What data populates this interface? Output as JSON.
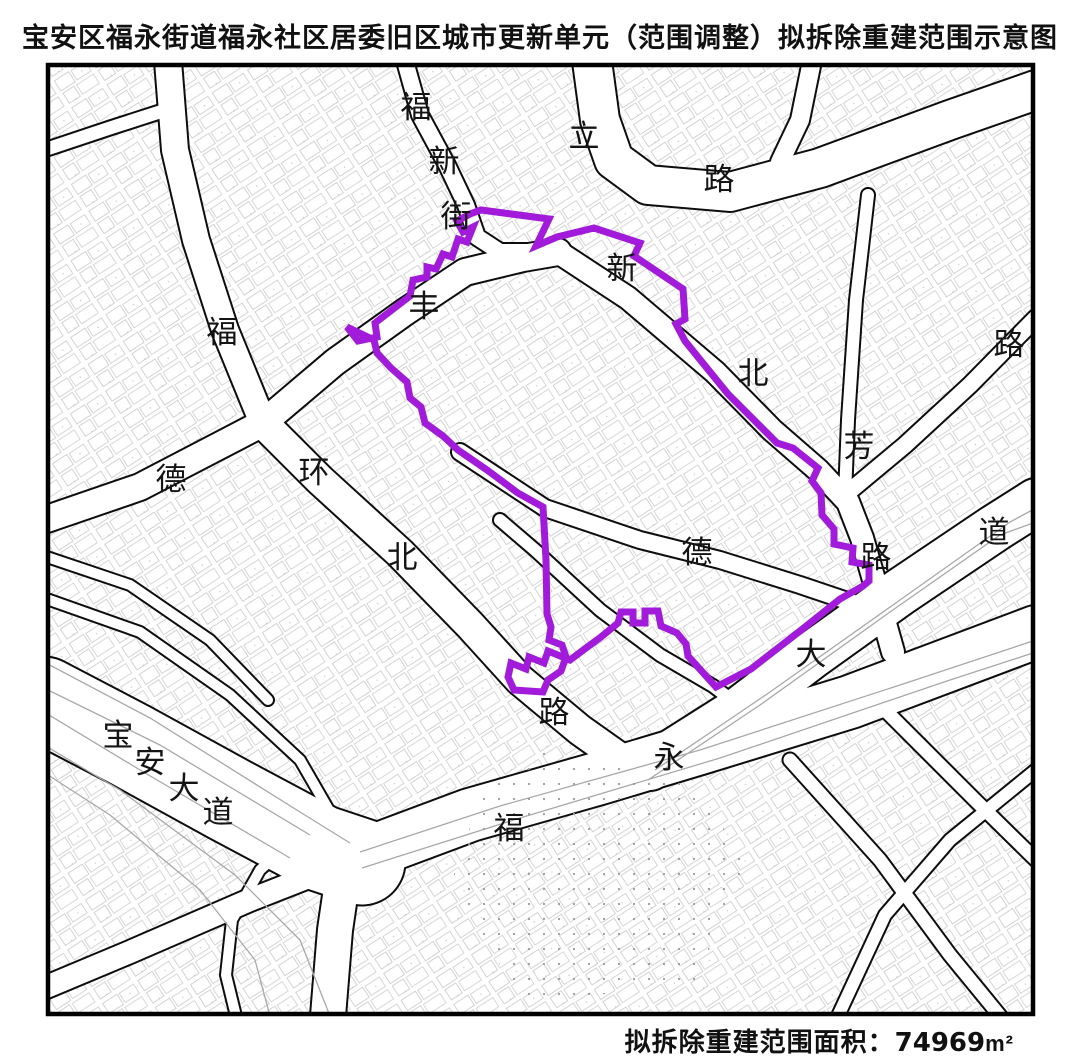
{
  "title": "宝安区福永街道福永社区居委旧区城市更新单元（范围调整）拟拆除重建范围示意图",
  "caption": {
    "label": "拟拆除重建范围面积：",
    "value": "74969",
    "unit": "m²"
  },
  "colors": {
    "boundary": "#A21BDA",
    "road_edge": "#0d0d0d",
    "road_fill": "#ffffff",
    "lane_line": "#a8a8a8",
    "parcel_line": "#c6c6c6",
    "frame": "#000000",
    "label_text": "#141414"
  },
  "map": {
    "frame": {
      "x": 48,
      "y": 65,
      "width": 985,
      "height": 949
    },
    "boundary_polygon": {
      "name": "proposed-demolition-rebuild-boundary",
      "stroke_width": 7,
      "points": [
        [
          347,
          327
        ],
        [
          358,
          341
        ],
        [
          377,
          337
        ],
        [
          375,
          323
        ],
        [
          410,
          296
        ],
        [
          413,
          280
        ],
        [
          427,
          277
        ],
        [
          427,
          267
        ],
        [
          436,
          269
        ],
        [
          443,
          254
        ],
        [
          452,
          257
        ],
        [
          458,
          239
        ],
        [
          467,
          242
        ],
        [
          473,
          227
        ],
        [
          463,
          232
        ],
        [
          457,
          221
        ],
        [
          470,
          214
        ],
        [
          481,
          210
        ],
        [
          549,
          219
        ],
        [
          536,
          246
        ],
        [
          557,
          237
        ],
        [
          594,
          228
        ],
        [
          640,
          243
        ],
        [
          634,
          256
        ],
        [
          683,
          289
        ],
        [
          685,
          319
        ],
        [
          676,
          324
        ],
        [
          685,
          341
        ],
        [
          702,
          362
        ],
        [
          728,
          394
        ],
        [
          748,
          414
        ],
        [
          777,
          443
        ],
        [
          793,
          448
        ],
        [
          818,
          468
        ],
        [
          812,
          481
        ],
        [
          821,
          493
        ],
        [
          822,
          515
        ],
        [
          834,
          529
        ],
        [
          834,
          544
        ],
        [
          853,
          548
        ],
        [
          852,
          562
        ],
        [
          869,
          565
        ],
        [
          869,
          581
        ],
        [
          863,
          586
        ],
        [
          840,
          599
        ],
        [
          800,
          631
        ],
        [
          751,
          669
        ],
        [
          716,
          687
        ],
        [
          688,
          656
        ],
        [
          686,
          644
        ],
        [
          677,
          633
        ],
        [
          661,
          626
        ],
        [
          658,
          611
        ],
        [
          645,
          611
        ],
        [
          645,
          623
        ],
        [
          633,
          623
        ],
        [
          633,
          612
        ],
        [
          621,
          612
        ],
        [
          618,
          623
        ],
        [
          601,
          637
        ],
        [
          586,
          648
        ],
        [
          570,
          660
        ],
        [
          548,
          651
        ],
        [
          544,
          663
        ],
        [
          529,
          657
        ],
        [
          526,
          669
        ],
        [
          511,
          663
        ],
        [
          508,
          677
        ],
        [
          514,
          690
        ],
        [
          543,
          692
        ],
        [
          548,
          680
        ],
        [
          561,
          671
        ],
        [
          566,
          657
        ],
        [
          562,
          645
        ],
        [
          549,
          640
        ],
        [
          551,
          627
        ],
        [
          547,
          614
        ],
        [
          546,
          560
        ],
        [
          543,
          507
        ],
        [
          518,
          493
        ],
        [
          487,
          470
        ],
        [
          458,
          450
        ],
        [
          443,
          436
        ],
        [
          425,
          423
        ],
        [
          421,
          407
        ],
        [
          410,
          398
        ],
        [
          407,
          382
        ],
        [
          391,
          368
        ],
        [
          377,
          353
        ],
        [
          374,
          340
        ]
      ]
    },
    "roads": [
      {
        "name": "baoan-avenue",
        "width": 85,
        "points": [
          [
            44,
            700
          ],
          [
            130,
            745
          ],
          [
            230,
            800
          ],
          [
            320,
            848
          ],
          [
            362,
            862
          ]
        ]
      },
      {
        "name": "fuyong-avenue",
        "width": 52,
        "points": [
          [
            355,
            858
          ],
          [
            470,
            815
          ],
          [
            600,
            778
          ],
          [
            700,
            748
          ],
          [
            850,
            702
          ],
          [
            1036,
            632
          ]
        ]
      },
      {
        "name": "dadao-northeast",
        "width": 46,
        "points": [
          [
            650,
            767
          ],
          [
            740,
            710
          ],
          [
            812,
            655
          ],
          [
            900,
            592
          ],
          [
            995,
            528
          ],
          [
            1036,
            502
          ]
        ]
      },
      {
        "name": "south-branch",
        "width": 34,
        "points": [
          [
            345,
            862
          ],
          [
            335,
            930
          ],
          [
            328,
            1016
          ]
        ]
      },
      {
        "name": "southwest-branch",
        "width": 22,
        "points": [
          [
            352,
            860
          ],
          [
            250,
            900
          ],
          [
            130,
            952
          ],
          [
            44,
            988
          ]
        ]
      },
      {
        "name": "interchange-ramp",
        "width": 10,
        "points": [
          [
            310,
            825
          ],
          [
            260,
            870
          ],
          [
            232,
            920
          ],
          [
            226,
            975
          ],
          [
            236,
            1016
          ]
        ]
      },
      {
        "name": "huanbei-road",
        "width": 30,
        "points": [
          [
            263,
            423
          ],
          [
            320,
            480
          ],
          [
            400,
            553
          ],
          [
            470,
            625
          ],
          [
            520,
            680
          ],
          [
            580,
            730
          ],
          [
            628,
            764
          ]
        ]
      },
      {
        "name": "west-branch",
        "width": 26,
        "points": [
          [
            44,
            520
          ],
          [
            140,
            487
          ],
          [
            263,
            423
          ]
        ]
      },
      {
        "name": "north-branch",
        "width": 26,
        "points": [
          [
            263,
            423
          ],
          [
            225,
            330
          ],
          [
            196,
            240
          ],
          [
            175,
            150
          ],
          [
            168,
            61
          ]
        ]
      },
      {
        "name": "fufeng-road",
        "width": 26,
        "points": [
          [
            263,
            423
          ],
          [
            335,
            362
          ],
          [
            405,
            312
          ],
          [
            465,
            272
          ],
          [
            523,
            258
          ],
          [
            558,
            252
          ]
        ]
      },
      {
        "name": "fuxin-street",
        "width": 16,
        "points": [
          [
            405,
            61
          ],
          [
            420,
            115
          ],
          [
            447,
            165
          ],
          [
            466,
            205
          ],
          [
            477,
            237
          ],
          [
            500,
            252
          ],
          [
            545,
            252
          ]
        ]
      },
      {
        "name": "lilu-corridor",
        "width": 38,
        "points": [
          [
            592,
            61
          ],
          [
            600,
            120
          ],
          [
            614,
            160
          ],
          [
            648,
            185
          ],
          [
            730,
            192
          ],
          [
            820,
            168
          ],
          [
            950,
            120
          ],
          [
            1036,
            90
          ]
        ]
      },
      {
        "name": "top-branch",
        "width": 18,
        "points": [
          [
            812,
            61
          ],
          [
            800,
            120
          ],
          [
            780,
            162
          ]
        ]
      },
      {
        "name": "xinbeifang-road",
        "width": 22,
        "points": [
          [
            558,
            252
          ],
          [
            628,
            298
          ],
          [
            715,
            372
          ],
          [
            772,
            430
          ],
          [
            818,
            470
          ],
          [
            848,
            502
          ],
          [
            862,
            538
          ],
          [
            874,
            580
          ],
          [
            884,
            620
          ],
          [
            893,
            652
          ]
        ]
      },
      {
        "name": "de-road",
        "width": 16,
        "points": [
          [
            460,
            452
          ],
          [
            545,
            508
          ],
          [
            640,
            540
          ],
          [
            720,
            560
          ],
          [
            800,
            585
          ],
          [
            880,
            612
          ]
        ]
      },
      {
        "name": "northeast-connector",
        "width": 16,
        "points": [
          [
            845,
            495
          ],
          [
            905,
            445
          ],
          [
            970,
            385
          ],
          [
            1036,
            318
          ]
        ]
      },
      {
        "name": "minor-diagonal",
        "width": 12,
        "points": [
          [
            500,
            520
          ],
          [
            535,
            550
          ],
          [
            600,
            610
          ],
          [
            660,
            655
          ],
          [
            713,
            686
          ],
          [
            758,
            720
          ]
        ]
      },
      {
        "name": "topleft-street",
        "width": 13,
        "points": [
          [
            44,
            150
          ],
          [
            110,
            128
          ],
          [
            172,
            108
          ]
        ]
      },
      {
        "name": "leftmid-street-a",
        "width": 10,
        "points": [
          [
            44,
            598
          ],
          [
            140,
            632
          ],
          [
            230,
            695
          ],
          [
            300,
            760
          ],
          [
            330,
            812
          ]
        ]
      },
      {
        "name": "leftmid-street-b",
        "width": 10,
        "points": [
          [
            44,
            556
          ],
          [
            130,
            585
          ],
          [
            210,
            640
          ],
          [
            268,
            700
          ]
        ]
      },
      {
        "name": "bottomright-street-a",
        "width": 13,
        "points": [
          [
            880,
            705
          ],
          [
            975,
            800
          ],
          [
            1036,
            860
          ]
        ]
      },
      {
        "name": "bottomright-street-b",
        "width": 13,
        "points": [
          [
            790,
            760
          ],
          [
            880,
            860
          ],
          [
            950,
            955
          ],
          [
            1000,
            1016
          ]
        ]
      },
      {
        "name": "bottomright-cross",
        "width": 12,
        "points": [
          [
            1036,
            770
          ],
          [
            950,
            840
          ],
          [
            885,
            915
          ],
          [
            838,
            1016
          ]
        ]
      },
      {
        "name": "ne-vertical-street",
        "width": 12,
        "points": [
          [
            868,
            195
          ],
          [
            856,
            300
          ],
          [
            848,
            420
          ],
          [
            845,
            495
          ]
        ]
      }
    ],
    "lane_lines": [
      [
        [
          44,
          662
        ],
        [
          150,
          718
        ],
        [
          300,
          812
        ],
        [
          350,
          843
        ]
      ],
      [
        [
          44,
          688
        ],
        [
          160,
          745
        ],
        [
          310,
          835
        ]
      ],
      [
        [
          44,
          712
        ],
        [
          140,
          770
        ],
        [
          290,
          858
        ]
      ],
      [
        [
          360,
          852
        ],
        [
          500,
          806
        ],
        [
          700,
          750
        ],
        [
          900,
          685
        ],
        [
          1036,
          640
        ]
      ],
      [
        [
          362,
          868
        ],
        [
          520,
          818
        ],
        [
          720,
          758
        ],
        [
          950,
          680
        ],
        [
          1036,
          652
        ]
      ],
      [
        [
          655,
          770
        ],
        [
          770,
          692
        ],
        [
          900,
          600
        ],
        [
          1010,
          522
        ],
        [
          1036,
          508
        ]
      ],
      [
        [
          648,
          780
        ],
        [
          760,
          705
        ],
        [
          890,
          612
        ],
        [
          1000,
          535
        ],
        [
          1036,
          522
        ]
      ],
      [
        [
          44,
          745
        ],
        [
          120,
          790
        ],
        [
          235,
          875
        ],
        [
          300,
          940
        ],
        [
          330,
          1016
        ]
      ],
      [
        [
          48,
          775
        ],
        [
          110,
          815
        ],
        [
          200,
          890
        ],
        [
          255,
          960
        ],
        [
          270,
          1016
        ]
      ]
    ],
    "dotted_area": [
      [
        545,
        752
      ],
      [
        690,
        782
      ],
      [
        748,
        862
      ],
      [
        692,
        988
      ],
      [
        520,
        1000
      ],
      [
        452,
        880
      ],
      [
        482,
        792
      ]
    ],
    "labels": [
      {
        "text": "福",
        "x": 416,
        "y": 107,
        "road": "福新街"
      },
      {
        "text": "新",
        "x": 444,
        "y": 161,
        "road": "福新街"
      },
      {
        "text": "街",
        "x": 456,
        "y": 216,
        "road": "福新街"
      },
      {
        "text": "立",
        "x": 584,
        "y": 136,
        "road": "立路"
      },
      {
        "text": "路",
        "x": 719,
        "y": 179,
        "road": "立路"
      },
      {
        "text": "新",
        "x": 622,
        "y": 268,
        "road": "新北芳路"
      },
      {
        "text": "北",
        "x": 753,
        "y": 373,
        "road": "新北芳路"
      },
      {
        "text": "芳",
        "x": 859,
        "y": 446,
        "road": "新北芳路"
      },
      {
        "text": "路",
        "x": 876,
        "y": 557,
        "road": "新北芳路"
      },
      {
        "text": "丰",
        "x": 424,
        "y": 306,
        "road": "丰"
      },
      {
        "text": "福",
        "x": 222,
        "y": 332,
        "road": "福"
      },
      {
        "text": "德",
        "x": 171,
        "y": 479,
        "road": "德环北路"
      },
      {
        "text": "环",
        "x": 314,
        "y": 472,
        "road": "德环北路"
      },
      {
        "text": "北",
        "x": 402,
        "y": 557,
        "road": "德环北路"
      },
      {
        "text": "路",
        "x": 554,
        "y": 712,
        "road": "德环北路"
      },
      {
        "text": "德",
        "x": 697,
        "y": 552,
        "road": "德"
      },
      {
        "text": "大",
        "x": 811,
        "y": 654,
        "road": "大道"
      },
      {
        "text": "道",
        "x": 994,
        "y": 532,
        "road": "大道"
      },
      {
        "text": "路",
        "x": 1009,
        "y": 344,
        "road": "路"
      },
      {
        "text": "宝",
        "x": 118,
        "y": 735,
        "road": "宝安大道"
      },
      {
        "text": "安",
        "x": 150,
        "y": 762,
        "road": "宝安大道"
      },
      {
        "text": "大",
        "x": 184,
        "y": 788,
        "road": "宝安大道"
      },
      {
        "text": "道",
        "x": 218,
        "y": 812,
        "road": "宝安大道"
      },
      {
        "text": "福",
        "x": 509,
        "y": 828,
        "road": "福永"
      },
      {
        "text": "永",
        "x": 669,
        "y": 757,
        "road": "福永"
      }
    ]
  }
}
